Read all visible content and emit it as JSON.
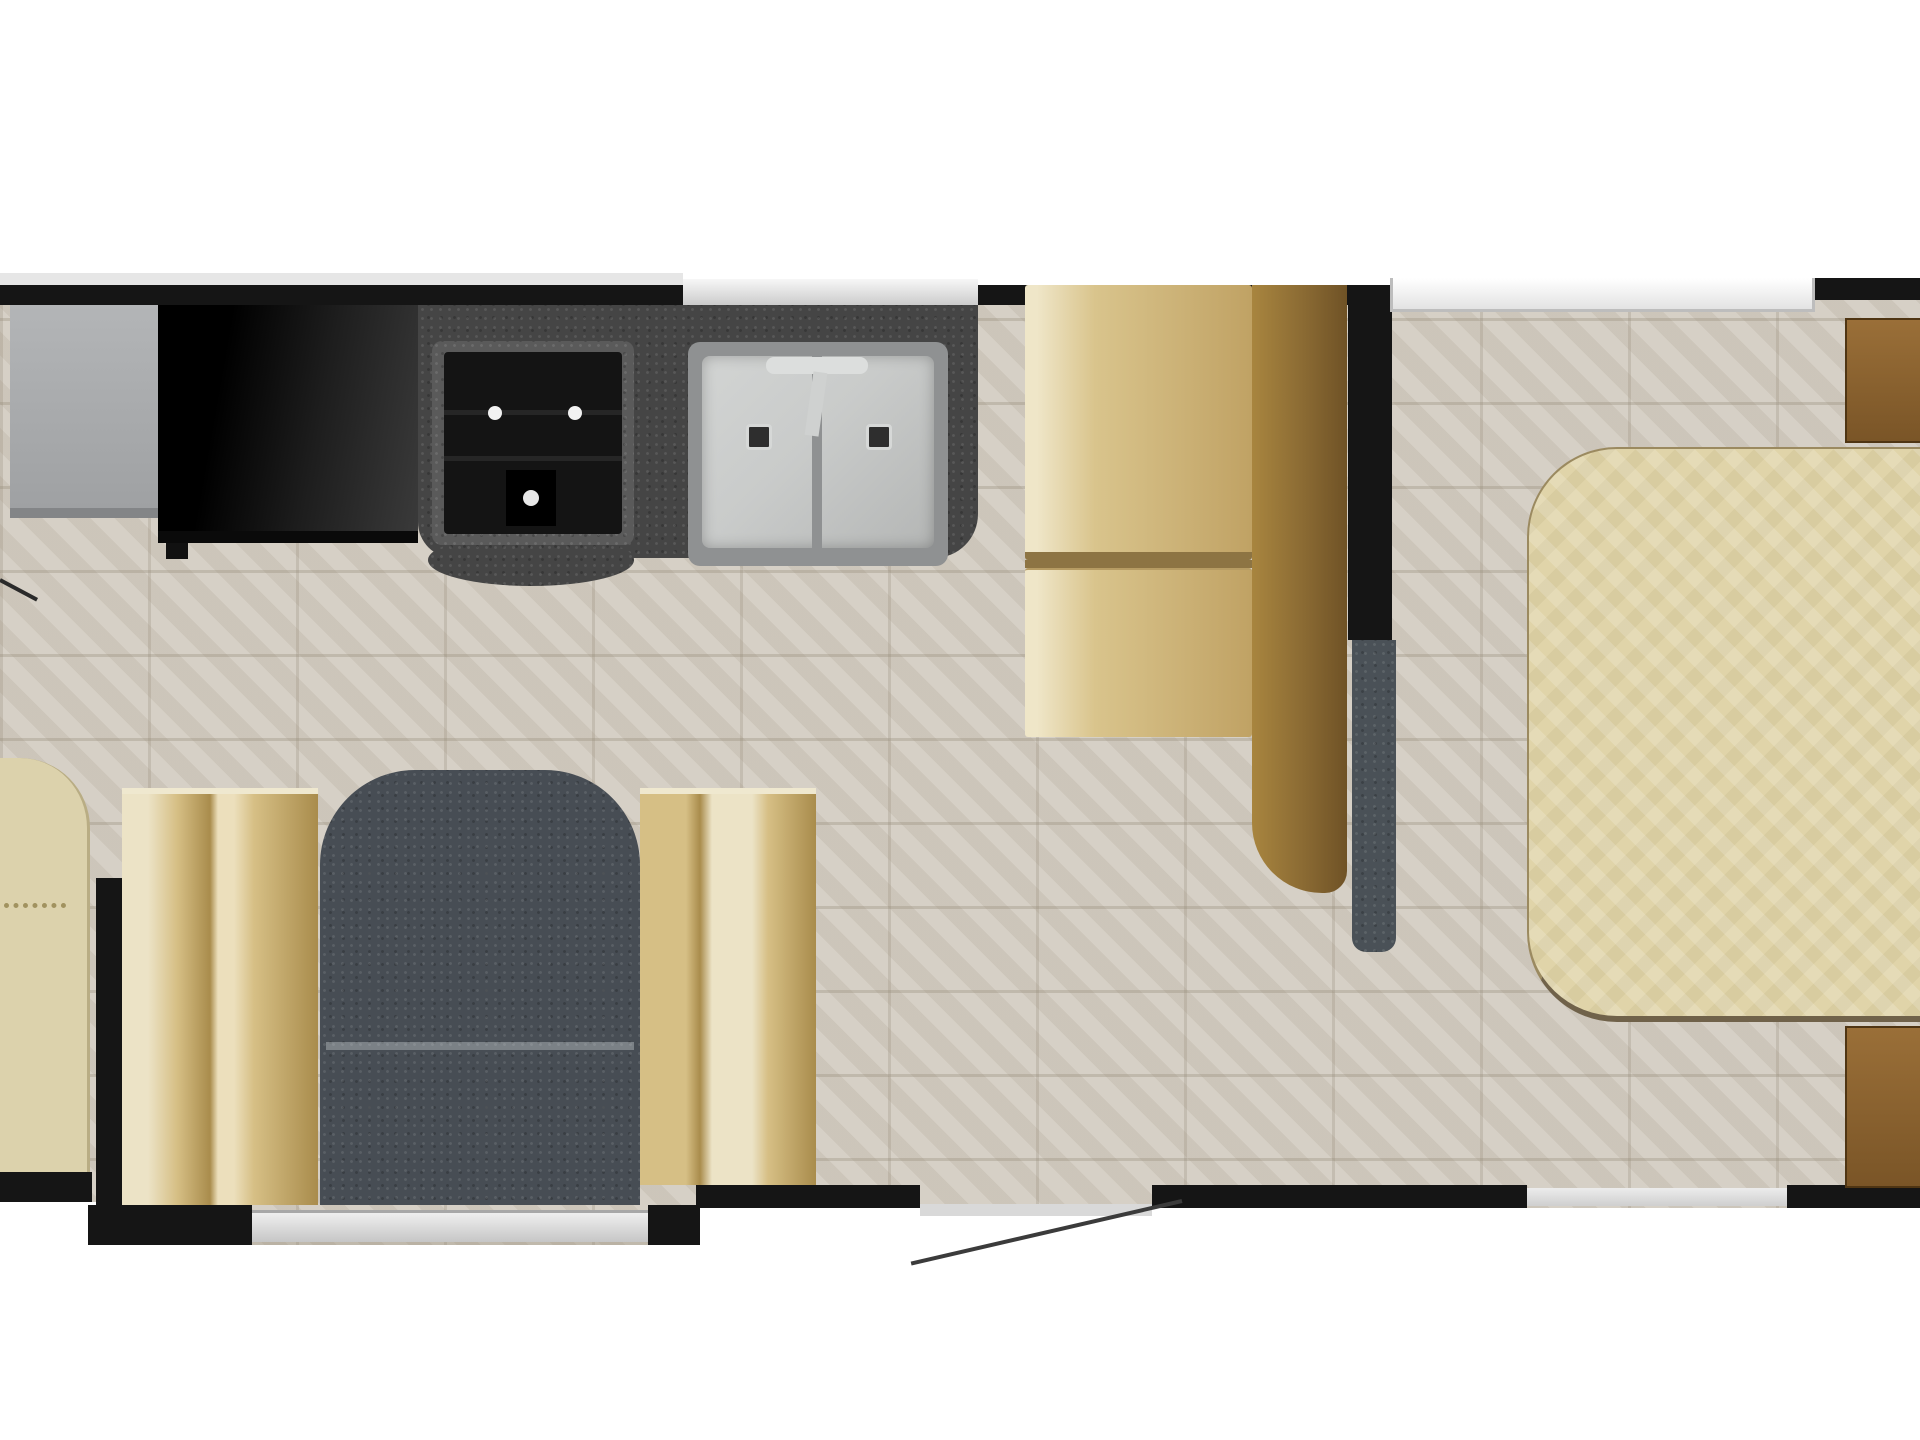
{
  "meta": {
    "title": "Travel trailer floor plan (top view)",
    "description": "RV floor plan: kitchen with refrigerator, TV cabinet, 3-burner cooktop and double sink along top wall; booth dinette; rear walk-around bed with two nightstands; living-area slide-out with two sofa benches and an armchair; entry door with swing arc on bottom wall; tiled flooring."
  },
  "palette": {
    "white": "#ffffff",
    "wall": "#151515",
    "tile": "#d3ccc1",
    "counter": "#454545",
    "stovecore": "#141414",
    "stoveframe": "#5a5a5a",
    "steel": "#c9cbca",
    "steeldark": "#8f9192",
    "fridge1": "#b3b5b7",
    "fridge2": "#9fa1a3",
    "tv1": "#000000",
    "tv2": "#3a3a3a",
    "cushion1": "#efe6c8",
    "cushion2": "#d9c48c",
    "cushion3": "#c0a264",
    "seam": "#8d7443",
    "wood1": "#a8853f",
    "wood2": "#6f5226",
    "dresser1": "#9a6f38",
    "dresser2": "#7a5527",
    "bed": "#e0d4a9",
    "bededge": "#9b8a60",
    "bedline": "#70624a",
    "slate": "#4a5157",
    "chair": "#474d54",
    "cream": "#ece3c6",
    "benchtan1": "#d6bf85",
    "benchtan2": "#a98c4c",
    "endseat": "#dcd2ac",
    "window1": "#f7f7f7",
    "window2": "#cccccc",
    "windowline": "#9f9f9f",
    "swing": "#3b3b3b"
  },
  "furniture": {
    "refrigerator": {
      "name": "refrigerator"
    },
    "tv_cabinet": {
      "name": "tv-entertainment-cabinet"
    },
    "cooktop": {
      "name": "range-cooktop",
      "burners": 3
    },
    "sink": {
      "name": "double-basin-sink",
      "basins": 2
    },
    "countertop": {
      "name": "kitchen-countertop"
    },
    "dinette": {
      "name": "booth-dinette",
      "cushions": 2
    },
    "pocket_door": {
      "name": "sliding-pocket-door"
    },
    "bed": {
      "name": "walk-around-queen-bed"
    },
    "nightstand_top": {
      "name": "nightstand"
    },
    "nightstand_bottom": {
      "name": "nightstand"
    },
    "bench_left": {
      "name": "sofa-bench-left"
    },
    "bench_right": {
      "name": "sofa-bench-right"
    },
    "armchair": {
      "name": "armchair"
    },
    "end_seat": {
      "name": "corner-end-seat"
    },
    "entry_door": {
      "name": "entry-door-swing"
    },
    "front_door": {
      "name": "front-compartment-door-swing"
    }
  },
  "openings": {
    "top_window_kitchen": {
      "name": "kitchen-window"
    },
    "top_window_bedroom": {
      "name": "bedroom-window"
    },
    "slideout_window": {
      "name": "slide-out-window"
    },
    "rear_bottom_window": {
      "name": "bedroom-rear-window"
    },
    "entry_door_gap": {
      "name": "entry-door-opening"
    }
  }
}
